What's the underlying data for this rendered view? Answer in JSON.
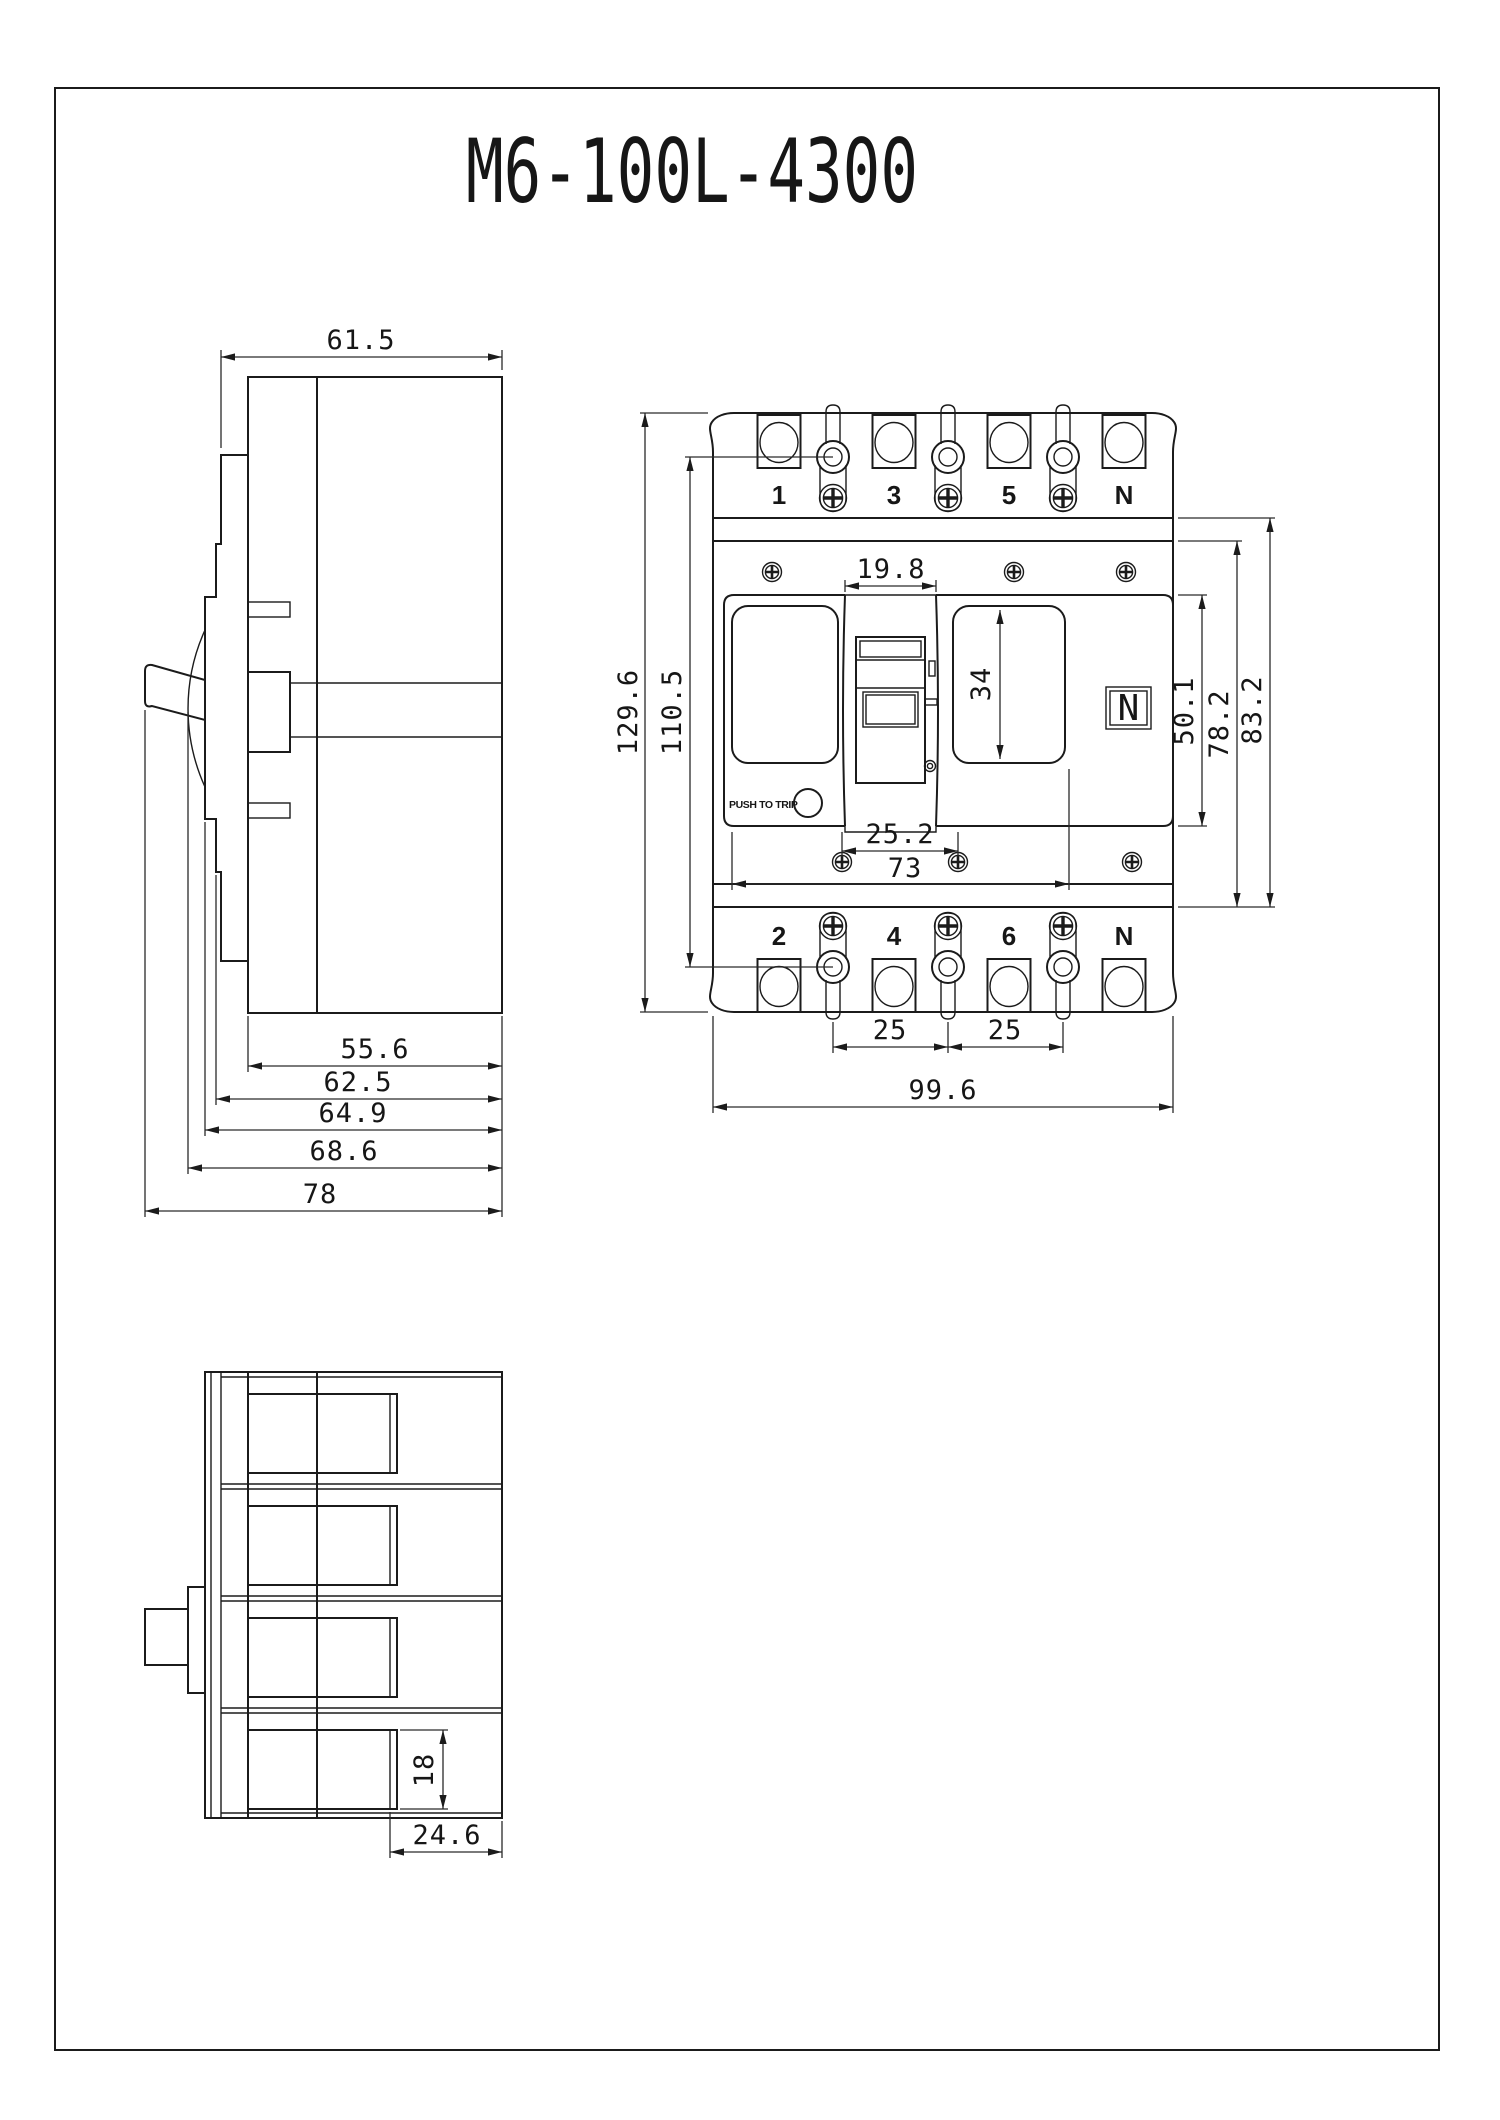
{
  "title": "M6-100L-4300",
  "side_view": {
    "dims": {
      "width": "61.5",
      "chain_1": "55.6",
      "chain_2": "62.5",
      "chain_3": "64.9",
      "chain_4": "68.6",
      "chain_5": "78"
    }
  },
  "front_view": {
    "top_terminals": [
      "1",
      "3",
      "5",
      "N"
    ],
    "bottom_terminals": [
      "2",
      "4",
      "6",
      "N"
    ],
    "push_to_trip": "PUSH TO TRIP",
    "neutral_label": "N",
    "dims": {
      "height": "129.6",
      "inner_height": "110.5",
      "handle_width": "19.8",
      "recess_height": "34",
      "escutcheon_height": "50.1",
      "band_inner": "78.2",
      "band_outer": "83.2",
      "screw_pitch": "25.2",
      "screw_span": "73",
      "pole_pitch_1": "25",
      "pole_pitch_2": "25",
      "width": "99.6"
    }
  },
  "bottom_view": {
    "dims": {
      "slot_height": "18",
      "terminal_depth": "24.6"
    }
  }
}
